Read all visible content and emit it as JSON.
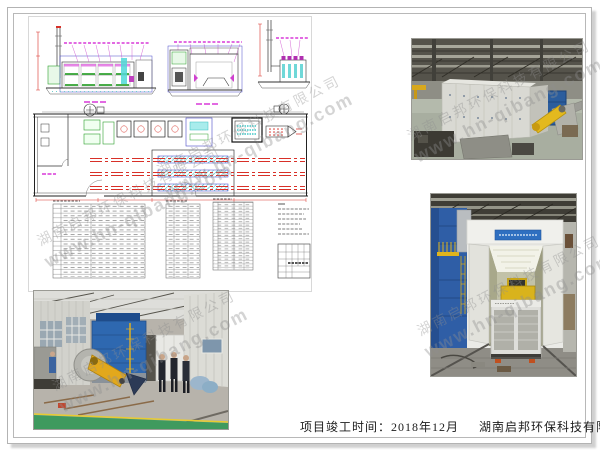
{
  "document": {
    "caption": {
      "project_completion": "项目竣工时间：2018年12月",
      "company": "湖南启邦环保科技有限公司"
    },
    "watermark": {
      "company": "湖南启邦环保科技有限公司",
      "website": "www.hn-qibang.com"
    },
    "drawing": {
      "colors": {
        "outline_blue": "#4848c8",
        "dimension_magenta": "#d838d8",
        "rail_red": "#d83028",
        "equipment_green": "#2ca02c",
        "hatch_cyan": "#38c0c0"
      }
    },
    "photos": {
      "count": 3
    }
  }
}
